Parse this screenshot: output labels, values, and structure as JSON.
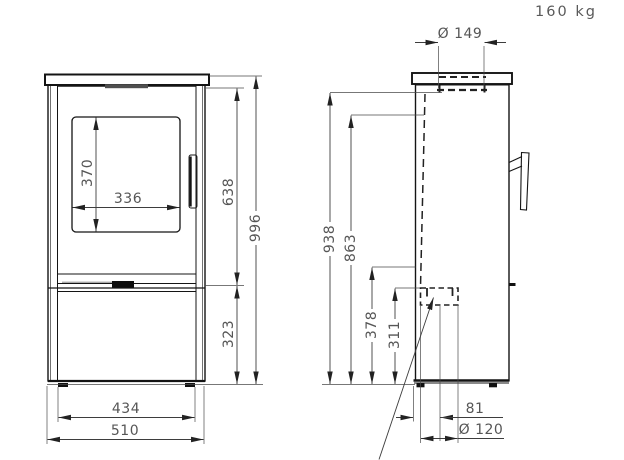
{
  "drawing": {
    "weight_label": "160 kg",
    "type_note": "stove dimensional drawing, front and side views"
  },
  "dimensions": {
    "front": {
      "glass_height": "370",
      "glass_width": "336",
      "upper_section_height": "638",
      "overall_height": "996",
      "base_section_height": "323",
      "feet_spacing": "434",
      "overall_width": "510"
    },
    "side": {
      "top_flue_diameter": "Ø 149",
      "rear_outlet_top_height": "938",
      "flue_centre_height": "863",
      "outlet_opening_height": "378",
      "rear_outlet_centre_height": "311",
      "rear_flue_offset": "81",
      "bottom_flue_diameter": "Ø 120"
    }
  },
  "colors": {
    "background": "#ffffff",
    "outline": "#141414",
    "dimension_line": "#3d3d3d",
    "label_text": "#565656"
  }
}
